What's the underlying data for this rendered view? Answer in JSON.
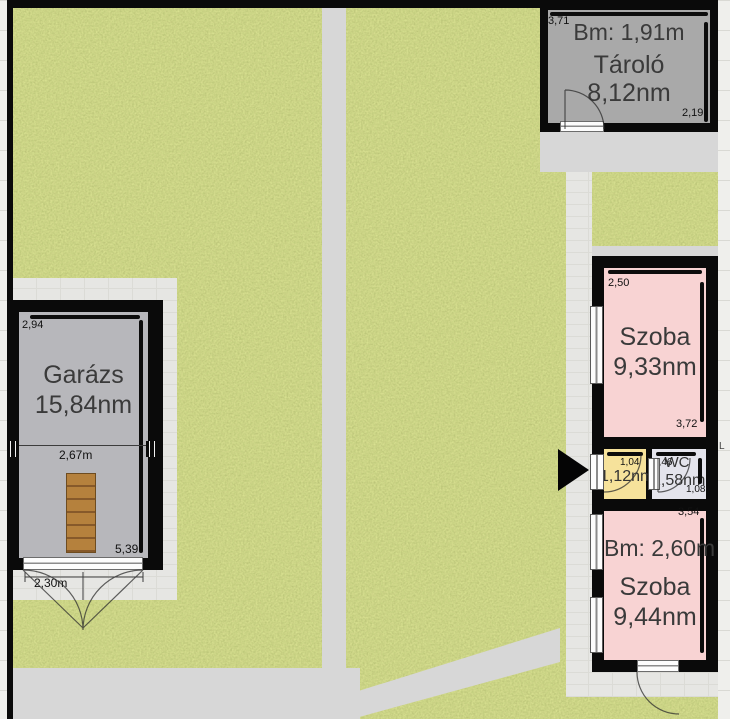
{
  "floorplan": {
    "tarolo": {
      "bm": "Bm: 1,91m",
      "name": "Tároló",
      "area": "8,12nm",
      "dim_width": "3,71",
      "dim_height": "2,19"
    },
    "garazs": {
      "name": "Garázs",
      "area": "15,84nm",
      "dim_width": "2,94",
      "dim_inner_width": "2,67m",
      "dim_depth": "5,39",
      "dim_door": "2,30m"
    },
    "szoba_felso": {
      "name": "Szoba",
      "area": "9,33nm",
      "dim_width": "2,50",
      "dim_height": "3,72"
    },
    "eloszoba": {
      "area": "1,12nm",
      "dim_width": "1,04"
    },
    "wc": {
      "name": "WC",
      "area": "1,58nm",
      "dim_width": "1,46",
      "dim_height": "1,08"
    },
    "szoba_also": {
      "bm": "Bm: 2,60m",
      "name": "Szoba",
      "area": "9,44nm",
      "dim_height": "3,54"
    },
    "edge_mark": "L",
    "colors": {
      "grass": "#8f9c4d",
      "path": "#d7d7d7",
      "pavement": "#e6e6e3",
      "sidewalk": "#efefec",
      "wall": "#0a0a0a",
      "storage_gray": "#a9a9a9",
      "garage_gray": "#b7b7bb",
      "room_pink": "#f8d3d3",
      "room_yellow": "#f6e29b",
      "room_wc": "#e4e4ec",
      "stairs_brown": "#b5813d"
    }
  }
}
